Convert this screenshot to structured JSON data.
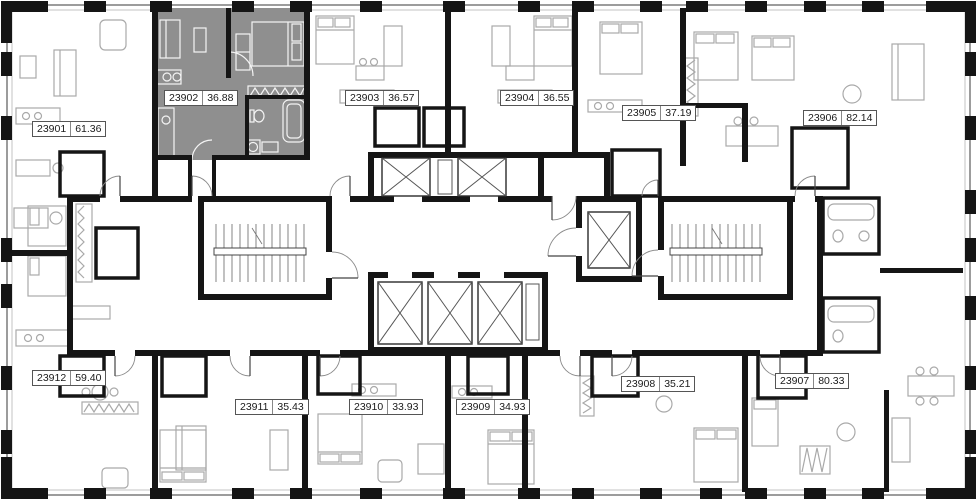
{
  "floor_plan": {
    "selected_unit_id": "23902",
    "colors": {
      "highlight": "#8f8f8f",
      "walls": "#151515",
      "furniture": "#a9a9a9",
      "furniture_on_highlight": "#f4f4f4",
      "badge_background": "#ffffff",
      "badge_border": "#555555"
    },
    "units": [
      {
        "id": "23901",
        "area": "61.36",
        "label_x": 32,
        "label_y": 121,
        "selected": false
      },
      {
        "id": "23902",
        "area": "36.88",
        "label_x": 164,
        "label_y": 90,
        "selected": true
      },
      {
        "id": "23903",
        "area": "36.57",
        "label_x": 345,
        "label_y": 90,
        "selected": false
      },
      {
        "id": "23904",
        "area": "36.55",
        "label_x": 500,
        "label_y": 90,
        "selected": false
      },
      {
        "id": "23905",
        "area": "37.19",
        "label_x": 622,
        "label_y": 105,
        "selected": false
      },
      {
        "id": "23906",
        "area": "82.14",
        "label_x": 803,
        "label_y": 110,
        "selected": false
      },
      {
        "id": "23907",
        "area": "80.33",
        "label_x": 775,
        "label_y": 373,
        "selected": false
      },
      {
        "id": "23908",
        "area": "35.21",
        "label_x": 621,
        "label_y": 376,
        "selected": false
      },
      {
        "id": "23909",
        "area": "34.93",
        "label_x": 456,
        "label_y": 399,
        "selected": false
      },
      {
        "id": "23910",
        "area": "33.93",
        "label_x": 349,
        "label_y": 399,
        "selected": false
      },
      {
        "id": "23911",
        "area": "35.43",
        "label_x": 235,
        "label_y": 399,
        "selected": false
      },
      {
        "id": "23912",
        "area": "59.40",
        "label_x": 32,
        "label_y": 370,
        "selected": false
      }
    ]
  }
}
